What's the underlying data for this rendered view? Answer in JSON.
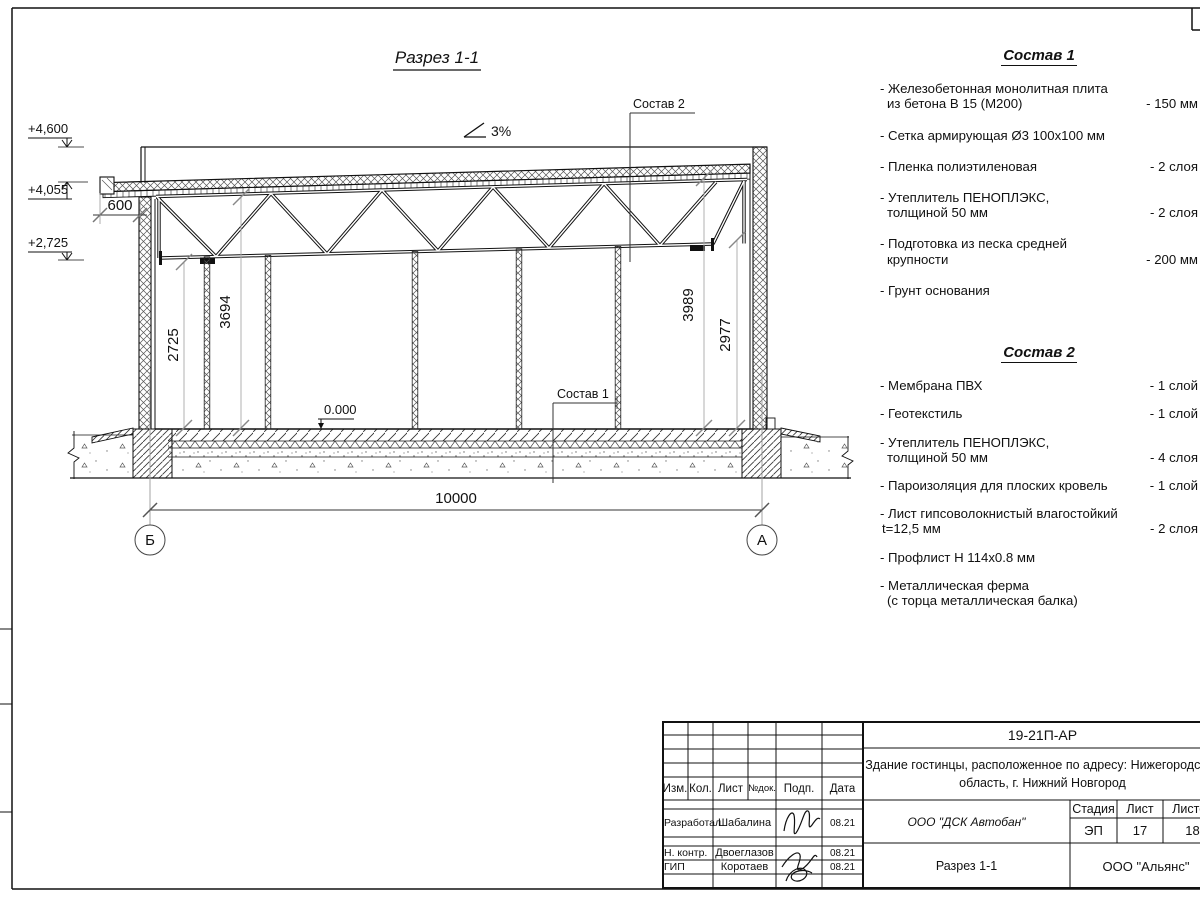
{
  "sheet": {
    "drawing": {
      "title": "Разрез 1-1",
      "slope": "3%",
      "elev_top": "+4,600",
      "elev_roof": "+4,055",
      "elev_chord": "+2,725",
      "level_floor": "0.000",
      "dim_overhang": "600",
      "dim_span": "10000",
      "dim_h1": "2725",
      "dim_h2": "3694",
      "dim_h3": "3989",
      "dim_h4": "2977",
      "axis_left": "Б",
      "axis_right": "А",
      "callout_floor": "Состав 1",
      "callout_roof": "Состав 2"
    },
    "spec1": {
      "title": "Состав 1",
      "items": [
        {
          "l1": "- Железобетонная  монолитная плита",
          "l2": "из бетона В 15 (М200)",
          "value": "- 150 мм"
        },
        {
          "l1": "- Сетка армирующая Ø3 100x100 мм",
          "l2": "",
          "value": ""
        },
        {
          "l1": "- Пленка полиэтиленовая",
          "l2": "",
          "value": "- 2 слоя"
        },
        {
          "l1": "- Утеплитель ПЕНОПЛЭКС,",
          "l2": "толщиной 50 мм",
          "value": "- 2 слоя"
        },
        {
          "l1": "- Подготовка из песка средней",
          "l2": "крупности",
          "value": "- 200 мм"
        },
        {
          "l1": "- Грунт основания",
          "l2": "",
          "value": ""
        }
      ]
    },
    "spec2": {
      "title": "Состав 2",
      "items": [
        {
          "l1": "- Мембрана ПВХ",
          "l2": "",
          "value": "- 1 слой"
        },
        {
          "l1": "- Геотекстиль",
          "l2": "",
          "value": "- 1 слой"
        },
        {
          "l1": "- Утеплитель ПЕНОПЛЭКС,",
          "l2": "толщиной 50 мм",
          "value": "- 4 слоя"
        },
        {
          "l1": "- Пароизоляция для плоских кровель",
          "l2": "",
          "value": "- 1 слой"
        },
        {
          "l1": "- Лист гипсоволокнистый влагостойкий",
          "l2": "t=12,5 мм",
          "value": "- 2 слоя"
        },
        {
          "l1": "- Профлист Н 114x0.8 мм",
          "l2": "",
          "value": ""
        },
        {
          "l1": "- Металлическая ферма",
          "l2": "(с торца металлическая балка)",
          "value": ""
        }
      ]
    },
    "titleblock": {
      "doc_number": "19-21П-АР",
      "project_line1": "Здание гостинцы, расположенное по адресу: Нижегородская",
      "project_line2": "область, г. Нижний Новгород",
      "org": "ООО \"ДСК Автобан\"",
      "sheet_title": "Разрез 1-1",
      "company": "ООО \"Альянс\"",
      "stage_label": "Стадия",
      "stage": "ЭП",
      "sheet_label": "Лист",
      "sheet_num": "17",
      "sheets_label": "Листов",
      "sheets_total": "18",
      "col_izm": "Изм.",
      "col_kol": "Кол.",
      "col_list": "Лист",
      "col_ndok": "№док.",
      "col_podp": "Подп.",
      "col_data": "Дата",
      "rows": [
        {
          "role": "Разработал",
          "name": "Шабалина",
          "date": "08.21"
        },
        {
          "role": "Н. контр.",
          "name": "Двоеглазов",
          "date": "08.21"
        },
        {
          "role": "ГИП",
          "name": "Коротаев",
          "date": "08.21"
        }
      ]
    }
  }
}
